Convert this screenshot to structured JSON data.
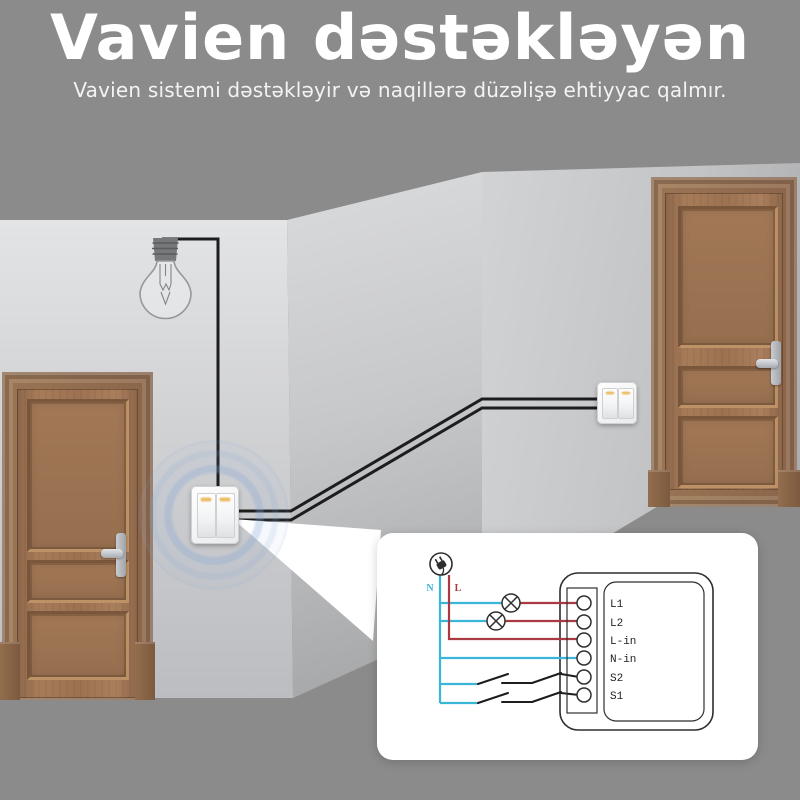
{
  "header": {
    "title": "Vavien dəstəkləyən",
    "subtitle": "Vavien sistemi dəstəkləyir və naqillərə düzəlişə ehtiyyac qalmır."
  },
  "scene": {
    "wire_color": "#1d1d1d",
    "elements": {
      "left_door": "wooden-door",
      "right_door": "wooden-door",
      "light_bulb": "hanging-bulb-icon",
      "left_switch": "double-rocker-wall-switch",
      "right_switch": "double-rocker-wall-switch",
      "glow": "blue-signal-glow",
      "beam": "callout-beam"
    }
  },
  "diagram": {
    "supply": {
      "neutral_label": "N",
      "live_label": "L"
    },
    "terminals": [
      {
        "label": "L1"
      },
      {
        "label": "L2"
      },
      {
        "label": "L-in"
      },
      {
        "label": "N-in"
      },
      {
        "label": "S2"
      },
      {
        "label": "S1"
      }
    ],
    "colors": {
      "neutral": "#3ab6d8",
      "live": "#a93a42",
      "signal": "#1d1d1d"
    }
  }
}
